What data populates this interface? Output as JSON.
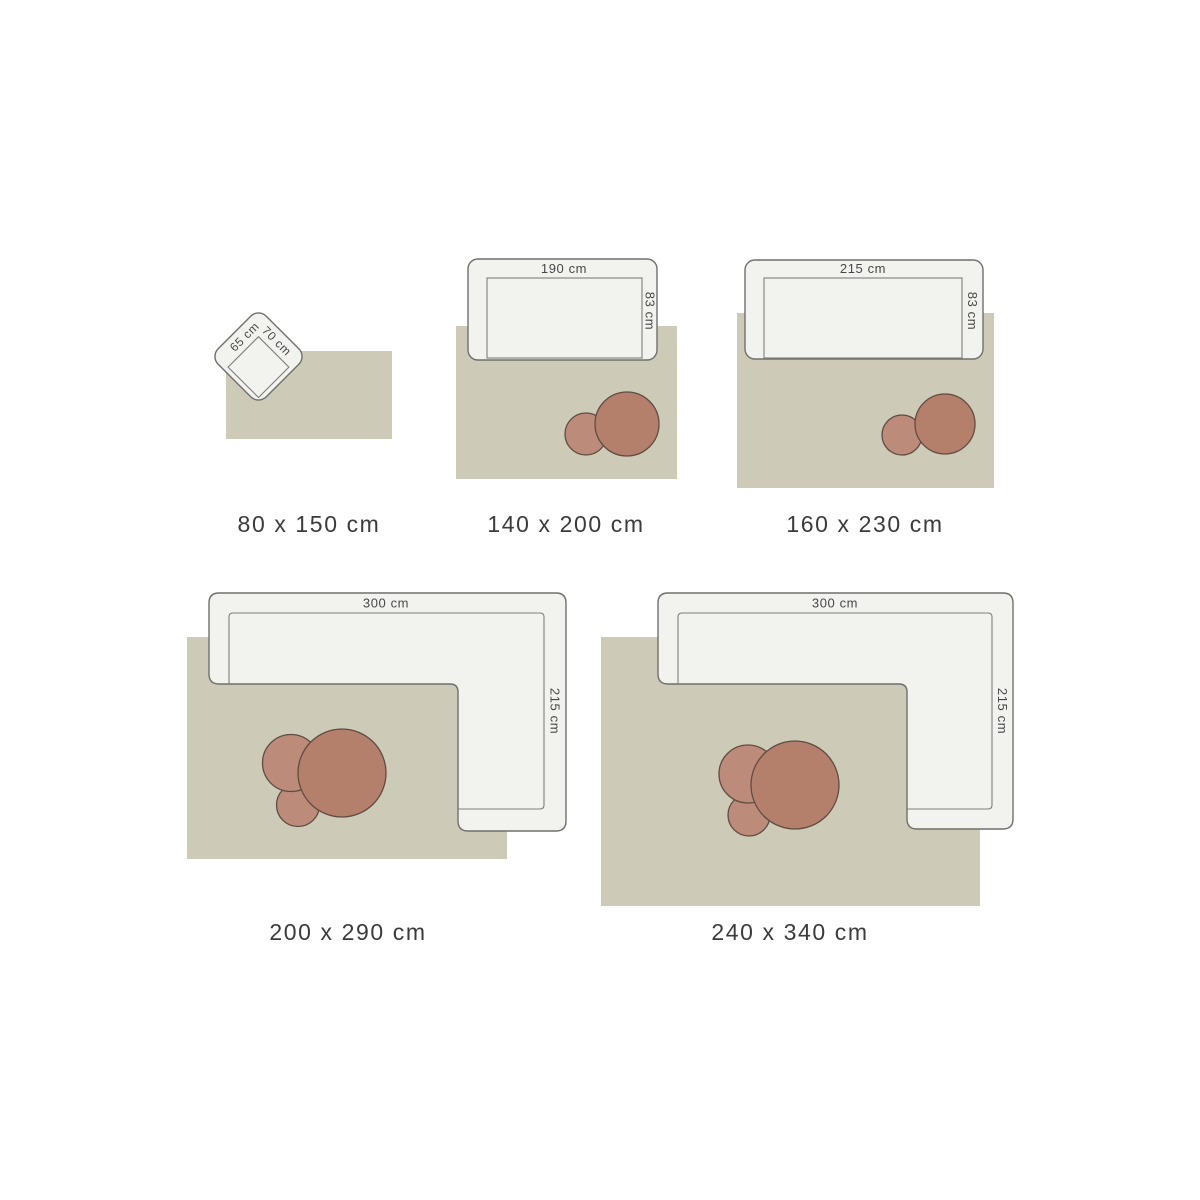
{
  "page": {
    "background": "#ffffff",
    "description_labels": {
      "unit": "cm"
    }
  },
  "colors": {
    "rug": "#cdcab8",
    "sofa_fill": "#f2f2ef",
    "sofa_outline": "#6f6f6d",
    "seat_outline": "#7d7d7b",
    "table_large": "#b5806b",
    "table_small": "#bc8b7a",
    "table_outline": "#5f4c43",
    "size_label_color": "#3b3b3b",
    "dim_label_color": "#474747"
  },
  "items": [
    {
      "name": "rug-80x150",
      "size_label": "80 x 150 cm",
      "furniture": {
        "type": "armchair",
        "side_label": "65 cm",
        "front_label": "70 cm"
      },
      "tables_count": 0
    },
    {
      "name": "rug-140x200",
      "size_label": "140 x 200 cm",
      "furniture": {
        "type": "sofa",
        "width_label": "190 cm",
        "depth_label": "83 cm"
      },
      "tables_count": 2
    },
    {
      "name": "rug-160x230",
      "size_label": "160 x 230 cm",
      "furniture": {
        "type": "sofa",
        "width_label": "215 cm",
        "depth_label": "83 cm"
      },
      "tables_count": 2
    },
    {
      "name": "rug-200x290",
      "size_label": "200 x 290 cm",
      "furniture": {
        "type": "corner-sofa",
        "width_label": "300 cm",
        "depth_label": "215 cm"
      },
      "tables_count": 3
    },
    {
      "name": "rug-240x340",
      "size_label": "240 x 340 cm",
      "furniture": {
        "type": "corner-sofa",
        "width_label": "300 cm",
        "depth_label": "215 cm"
      },
      "tables_count": 3
    }
  ]
}
